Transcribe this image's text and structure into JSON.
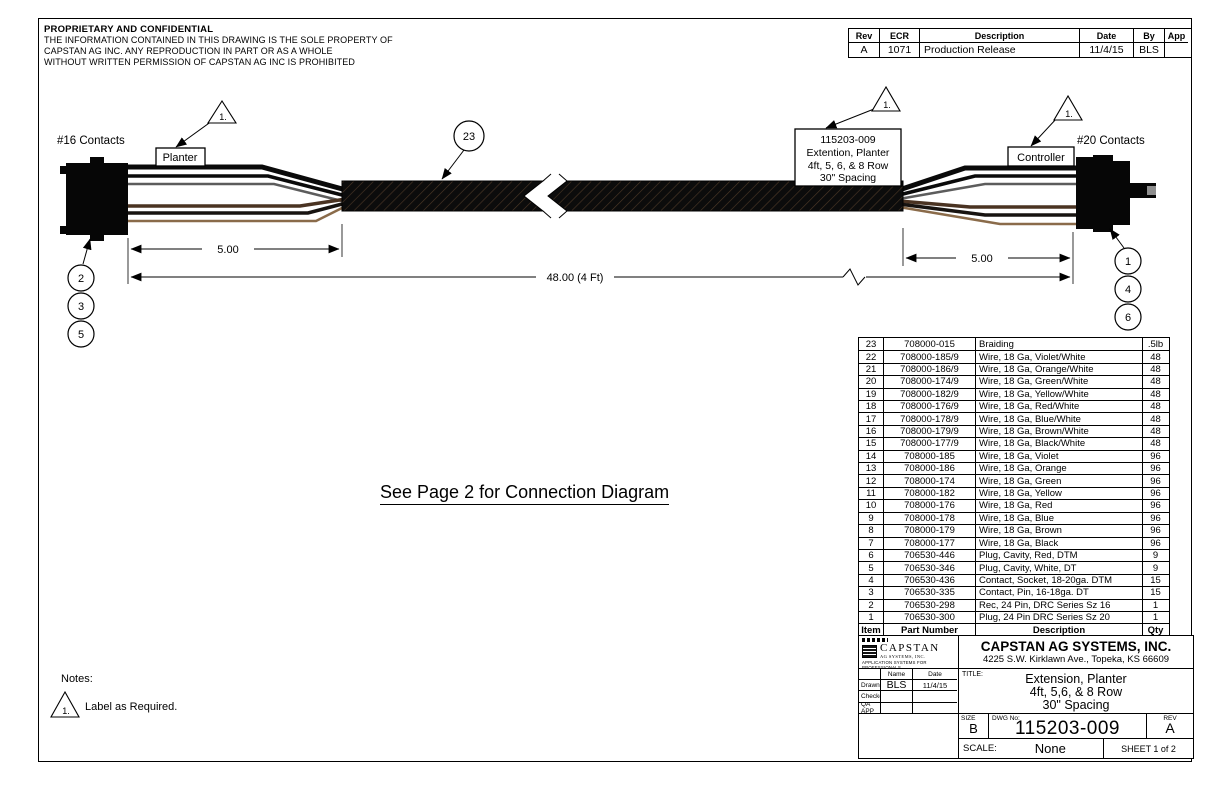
{
  "proprietary": {
    "title": "PROPRIETARY AND CONFIDENTIAL",
    "lines": [
      "THE INFORMATION CONTAINED IN THIS DRAWING IS THE SOLE PROPERTY OF",
      "CAPSTAN AG INC. ANY REPRODUCTION IN PART OR AS A WHOLE",
      "WITHOUT WRITTEN PERMISSION OF CAPSTAN AG INC IS PROHIBITED"
    ]
  },
  "revision": {
    "headers": [
      "Rev",
      "ECR",
      "Description",
      "Date",
      "By",
      "App"
    ],
    "row": [
      "A",
      "1071",
      "Production Release",
      "11/4/15",
      "BLS",
      ""
    ]
  },
  "diagram": {
    "left_contacts": "#16 Contacts",
    "right_contacts": "#20 Contacts",
    "planter": "Planter",
    "controller": "Controller",
    "cable_label_lines": [
      "115203-009",
      "Extention, Planter",
      "4ft, 5, 6, & 8 Row",
      "30\" Spacing"
    ],
    "flag": "1.",
    "balloons": {
      "braiding": "23",
      "left": [
        "2",
        "3",
        "5"
      ],
      "right": [
        "1",
        "4",
        "6"
      ]
    },
    "dims": {
      "left": "5.00",
      "overall": "48.00 (4 Ft)",
      "right": "5.00"
    }
  },
  "center_note": "See Page 2 for Connection Diagram",
  "notes": {
    "heading": "Notes:",
    "flag": "1.",
    "note1": "Label as Required."
  },
  "bom": {
    "headers": [
      "Item",
      "Part Number",
      "Description",
      "Qty"
    ],
    "rows": [
      [
        "23",
        "708000-015",
        "Braiding",
        ".5lb"
      ],
      [
        "22",
        "708000-185/9",
        "Wire, 18 Ga, Violet/White",
        "48"
      ],
      [
        "21",
        "708000-186/9",
        "Wire, 18 Ga, Orange/White",
        "48"
      ],
      [
        "20",
        "708000-174/9",
        "Wire, 18 Ga, Green/White",
        "48"
      ],
      [
        "19",
        "708000-182/9",
        "Wire, 18 Ga, Yellow/White",
        "48"
      ],
      [
        "18",
        "708000-176/9",
        "Wire, 18 Ga, Red/White",
        "48"
      ],
      [
        "17",
        "708000-178/9",
        "Wire, 18 Ga, Blue/White",
        "48"
      ],
      [
        "16",
        "708000-179/9",
        "Wire, 18 Ga, Brown/White",
        "48"
      ],
      [
        "15",
        "708000-177/9",
        "Wire, 18 Ga, Black/White",
        "48"
      ],
      [
        "14",
        "708000-185",
        "Wire, 18 Ga, Violet",
        "96"
      ],
      [
        "13",
        "708000-186",
        "Wire, 18 Ga, Orange",
        "96"
      ],
      [
        "12",
        "708000-174",
        "Wire, 18 Ga, Green",
        "96"
      ],
      [
        "11",
        "708000-182",
        "Wire, 18 Ga, Yellow",
        "96"
      ],
      [
        "10",
        "708000-176",
        "Wire, 18 Ga, Red",
        "96"
      ],
      [
        "9",
        "708000-178",
        "Wire, 18 Ga, Blue",
        "96"
      ],
      [
        "8",
        "708000-179",
        "Wire, 18 Ga, Brown",
        "96"
      ],
      [
        "7",
        "708000-177",
        "Wire, 18 Ga, Black",
        "96"
      ],
      [
        "6",
        "706530-446",
        "Plug, Cavity, Red, DTM",
        "9"
      ],
      [
        "5",
        "706530-346",
        "Plug, Cavity, White, DT",
        "9"
      ],
      [
        "4",
        "706530-436",
        "Contact, Socket, 18-20ga. DTM",
        "15"
      ],
      [
        "3",
        "706530-335",
        "Contact, Pin, 16-18ga. DT",
        "15"
      ],
      [
        "2",
        "706530-298",
        "Rec, 24 Pin, DRC Series Sz 16",
        "1"
      ],
      [
        "1",
        "706530-300",
        "Plug, 24 Pin DRC Series Sz 20",
        "1"
      ]
    ]
  },
  "title_block": {
    "logo": {
      "name": "CAPSTAN",
      "sub": "AG SYSTEMS, INC.",
      "tagline": "APPLICATION SYSTEMS FOR PROFESSIONALS"
    },
    "company_name": "CAPSTAN AG SYSTEMS, INC.",
    "company_address": "4225 S.W. Kirklawn Ave., Topeka, KS 66609",
    "signoff": {
      "name_header": "Name",
      "date_header": "Date",
      "rows": [
        {
          "label": "Drawn",
          "name": "BLS",
          "date": "11/4/15"
        },
        {
          "label": "Checked",
          "name": "",
          "date": ""
        },
        {
          "label": "QA APP",
          "name": "",
          "date": ""
        }
      ]
    },
    "title_label": "TITLE:",
    "title_lines": [
      "Extension, Planter",
      "4ft, 5,6, & 8 Row",
      "30\" Spacing"
    ],
    "size_label": "SIZE",
    "size_value": "B",
    "dwg_label": "DWG No:",
    "dwg_value": "115203-009",
    "rev_label": "REV",
    "rev_value": "A",
    "scale_label": "SCALE:",
    "scale_value": "None",
    "sheet_label": "SHEET 1 of 2"
  },
  "colors": {
    "line": "#000000",
    "wire_black": "#0a0a0a",
    "wire_gray": "#5c5c5c",
    "wire_brown": "#4a3322",
    "wire_dark": "#171310",
    "wire_tan": "#8a6b4a"
  }
}
